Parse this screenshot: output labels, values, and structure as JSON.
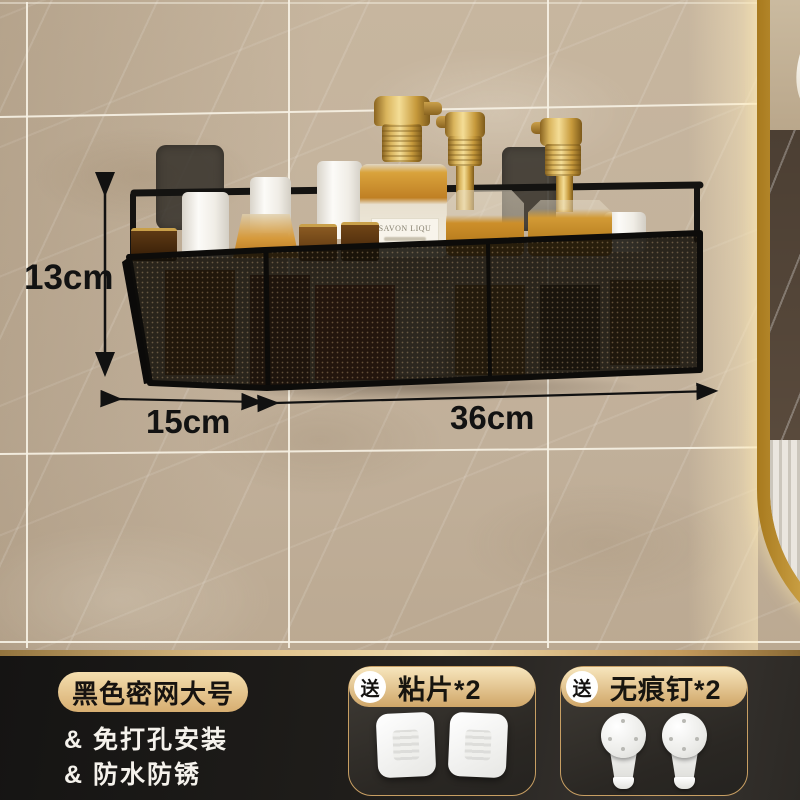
{
  "dimensions": {
    "height_label": "13cm",
    "depth_label": "15cm",
    "width_label": "36cm"
  },
  "bottle_label": {
    "line1": "SAVON LIQU"
  },
  "banner": {
    "badge": "黑色密网大号",
    "features": [
      "& 免打孔安装",
      "& 防水防锈"
    ]
  },
  "gifts": [
    {
      "tag": "送",
      "name": "粘片*2"
    },
    {
      "tag": "送",
      "name": "无痕钉*2"
    }
  ],
  "colors": {
    "gold_accent": "#d2a96b",
    "banner_bg": "#25231f",
    "shelf_black": "#141311",
    "amber_liquid": "#c2851f",
    "wall_beige": "#bcab95",
    "mirror_frame_gold": "#c8952e"
  }
}
